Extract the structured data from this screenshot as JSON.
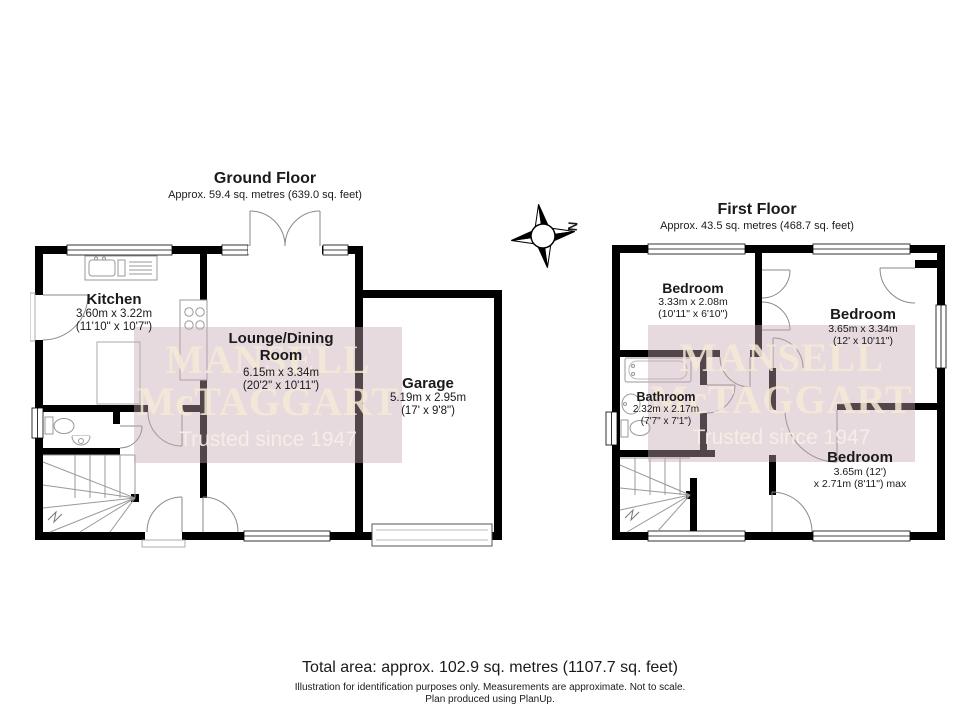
{
  "floors": [
    {
      "title": "Ground Floor",
      "subtitle": "Approx. 59.4 sq. metres (639.0 sq. feet)",
      "rooms": [
        {
          "name": "Kitchen",
          "line1": "3.60m x 3.22m",
          "line2": "(11'10\" x 10'7\")"
        },
        {
          "name": "Lounge/Dining Room",
          "line1": "6.15m x 3.34m",
          "line2": "(20'2\" x 10'11\")"
        },
        {
          "name": "Garage",
          "line1": "5.19m x 2.95m",
          "line2": "(17' x 9'8\")"
        }
      ]
    },
    {
      "title": "First Floor",
      "subtitle": "Approx. 43.5 sq. metres (468.7 sq. feet)",
      "rooms": [
        {
          "name": "Bedroom",
          "line1": "3.33m x 2.08m",
          "line2": "(10'11\" x 6'10\")"
        },
        {
          "name": "Bedroom",
          "line1": "3.65m x 3.34m",
          "line2": "(12' x 10'11\")"
        },
        {
          "name": "Bathroom",
          "line1": "2.32m x 2.17m",
          "line2": "(7'7\" x 7'1\")"
        },
        {
          "name": "Bedroom",
          "line1": "3.65m (12')",
          "line2": "x 2.71m (8'11\") max"
        }
      ]
    }
  ],
  "watermark": {
    "line1": "MANSELL",
    "line2": "McTAGGART",
    "tagline": "Trusted since 1947",
    "box_color": "#e2d1d8",
    "text_color": "#f4ead6"
  },
  "compass": {
    "north_label": "N"
  },
  "footer": {
    "total_area": "Total area: approx. 102.9 sq. metres (1107.7 sq. feet)",
    "disclaimer": "Illustration for identification purposes only. Measurements are approximate. Not to scale.",
    "credit": "Plan produced using PlanUp."
  }
}
